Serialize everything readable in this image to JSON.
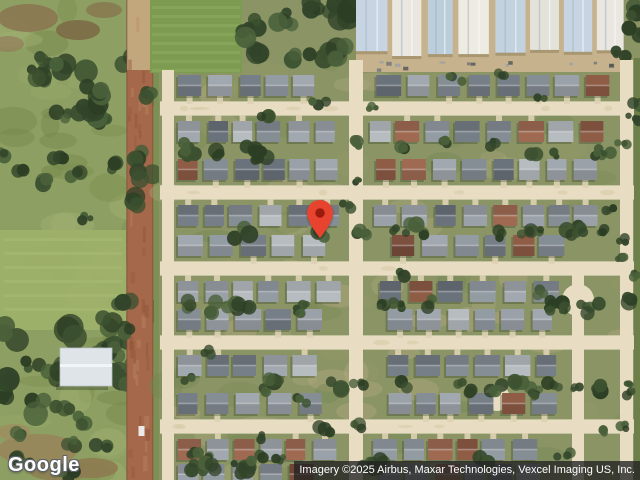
{
  "branding": {
    "logo_text": "Google"
  },
  "attribution": {
    "text": "Imagery ©2025 Airbus, Maxar Technologies, Vexcel Imaging US, Inc."
  },
  "marker": {
    "x": 320,
    "tip_y": 238,
    "width": 26,
    "height": 38
  },
  "colors": {
    "pin": "#E8432F",
    "pin_dot": "#9A1A0E",
    "street": "#E8DDC2",
    "dirt_road": "#A5684A",
    "dirt_road_top": "#C2A67C",
    "rural_grass": "#8D9F62",
    "bright_field": "#9EB169",
    "sports_field": "#7D9C52",
    "tree_dark": "#3C5130",
    "neighborhood_ground": "#8A9465",
    "greenhouse_blue": "#C7D5E2",
    "greenhouse_white": "#E9E7E0",
    "greenhouse_apron": "#C6B28C",
    "attribution_bg": "rgba(35,35,35,0.78)",
    "attribution_text": "#FFFFFF",
    "logo_text_color": "#FFFFFF"
  }
}
